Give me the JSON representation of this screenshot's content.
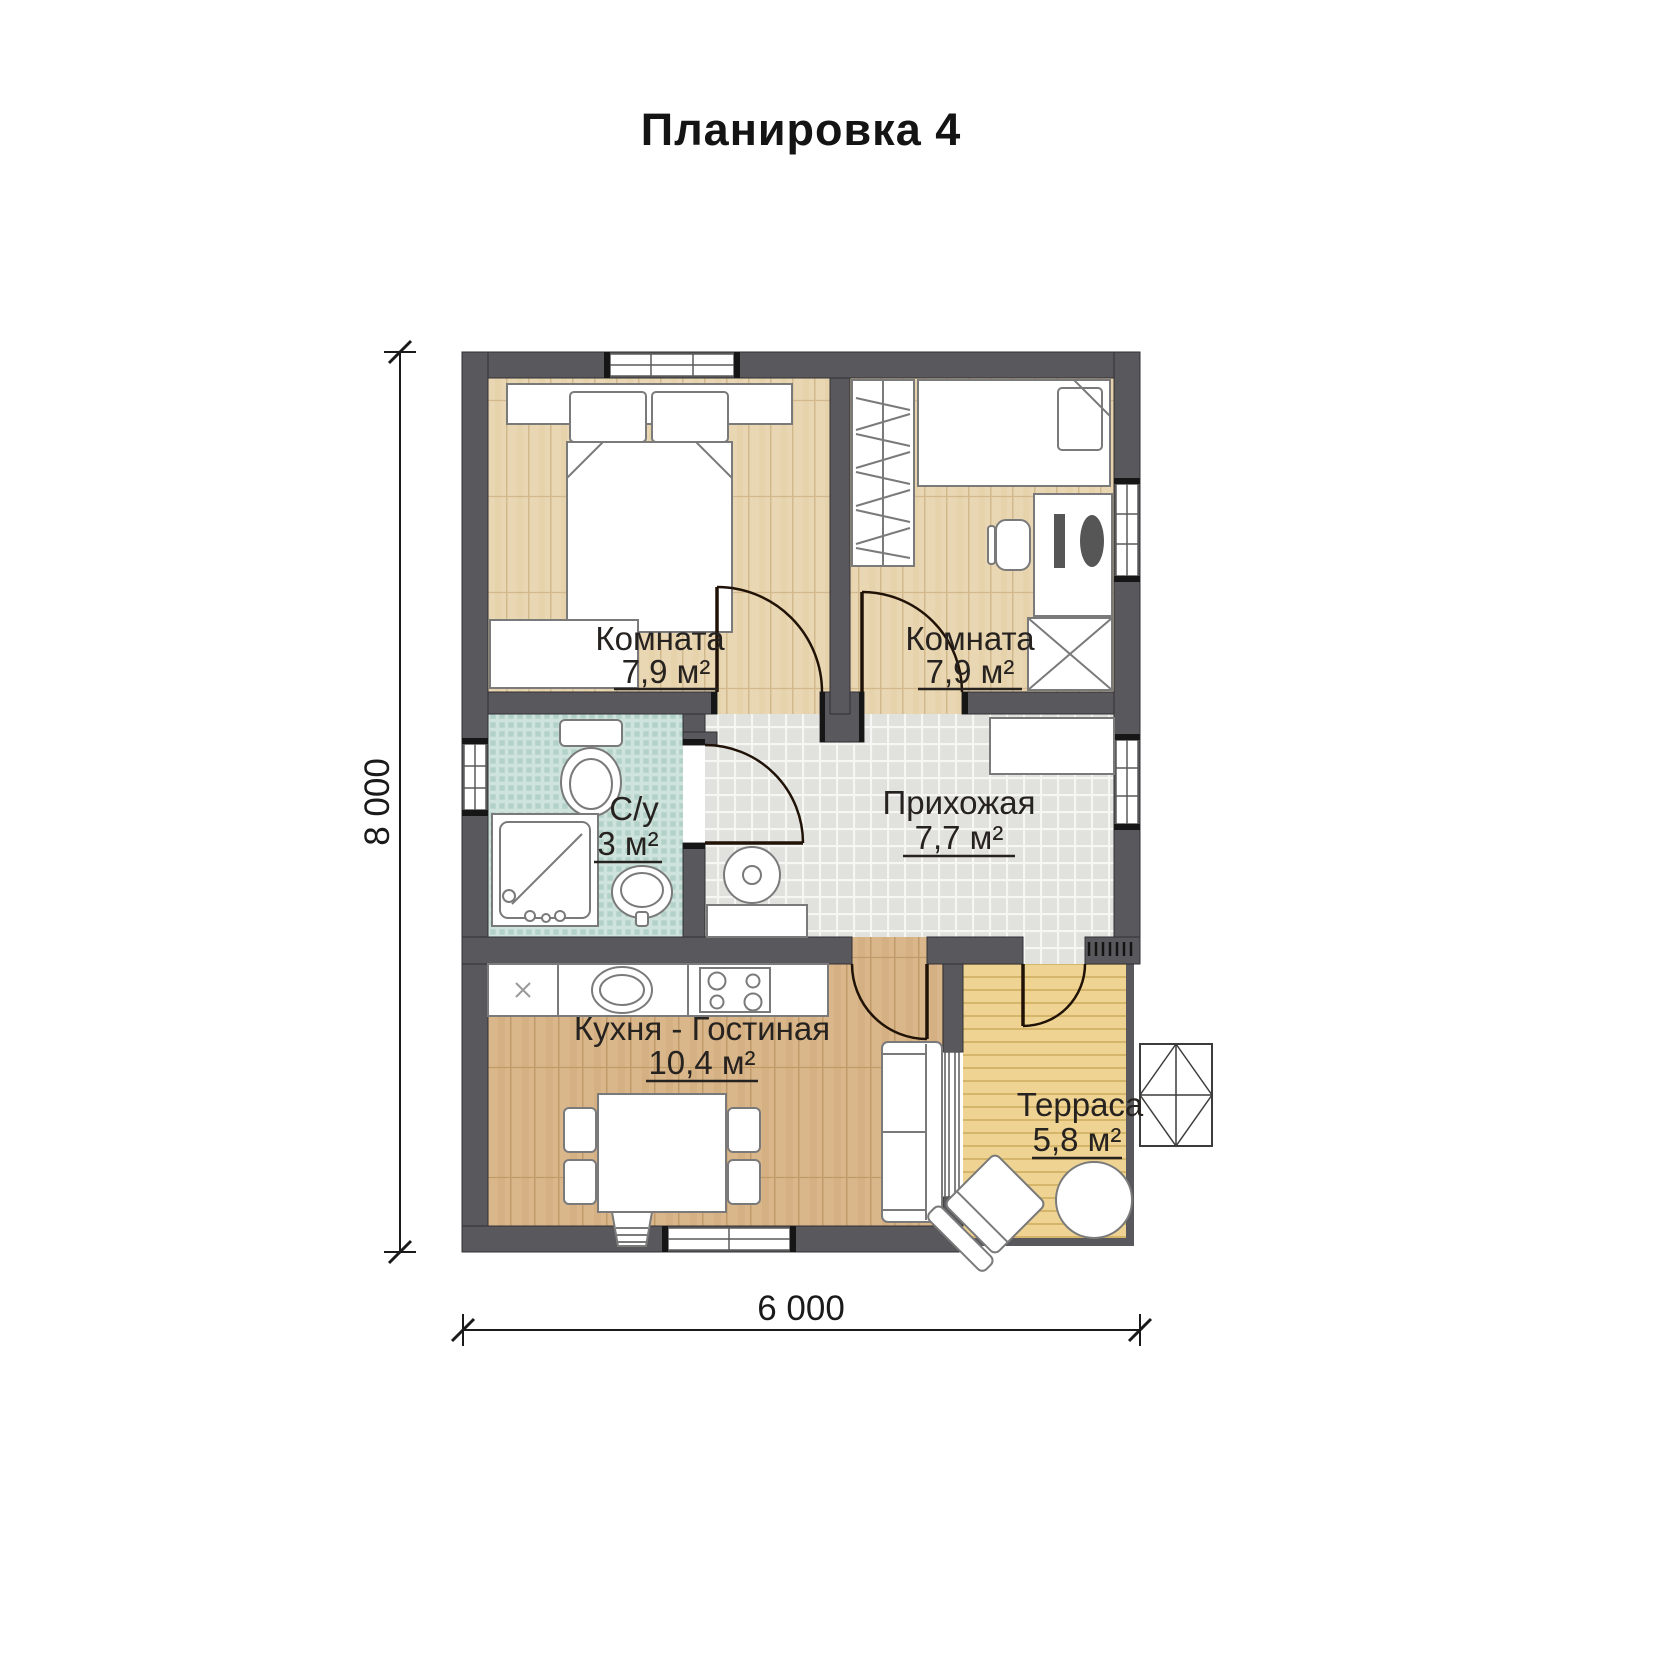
{
  "title": "Планировка 4",
  "plan": {
    "rooms": [
      {
        "key": "bedroom-1",
        "name": "Комната",
        "area": "7,9 м²"
      },
      {
        "key": "bedroom-2",
        "name": "Комната",
        "area": "7,9 м²"
      },
      {
        "key": "bathroom",
        "name": "С/у",
        "area": "3 м²"
      },
      {
        "key": "hallway",
        "name": "Прихожая",
        "area": "7,7 м²"
      },
      {
        "key": "kitchen-living",
        "name": "Кухня - Гостиная",
        "area": "10,4 м²"
      },
      {
        "key": "terrace",
        "name": "Терраса",
        "area": "5,8 м²"
      }
    ],
    "dimensions": {
      "vertical": "8 000",
      "horizontal": "6 000"
    },
    "colors": {
      "wall": "#59585c",
      "bedroom_floor": "#e9d6b2",
      "kitchen_floor": "#d9b78b",
      "hallway_tile": "#e3e3e0",
      "bathroom_tile": "#cfe3dd",
      "terrace_deck": "#eed392",
      "furniture": "#ffffff",
      "lines": "#201207"
    }
  }
}
